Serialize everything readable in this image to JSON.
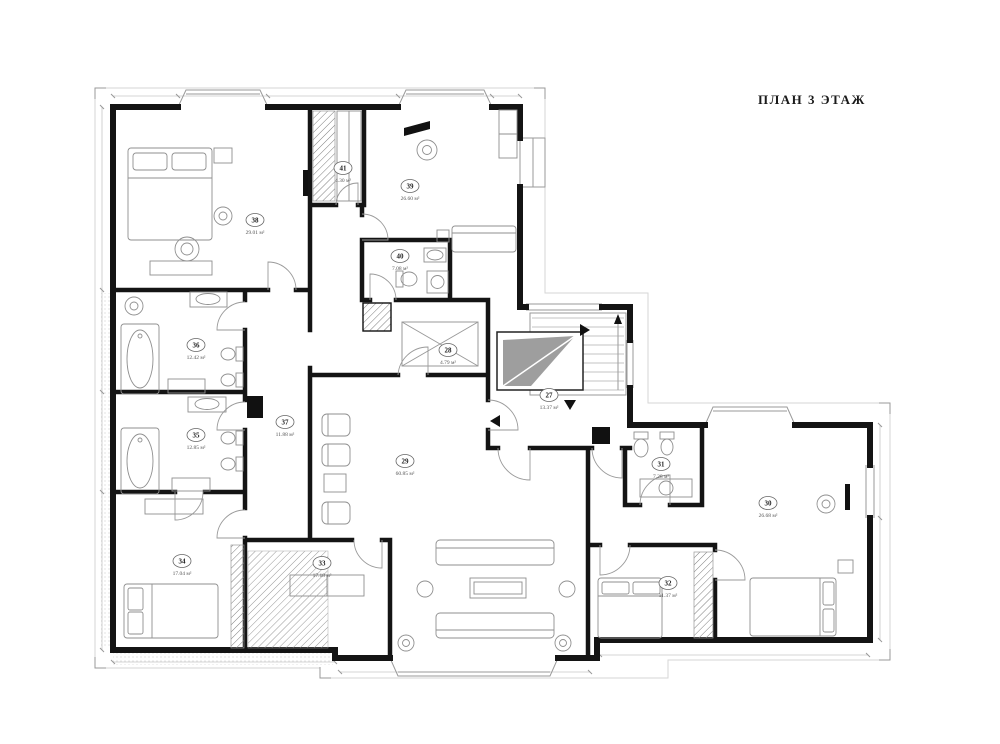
{
  "title": "ПЛАН 3 ЭТАЖ",
  "drawing": {
    "type": "floor-plan",
    "floor_label": "3",
    "units": "м²",
    "palette": {
      "wall": "#141414",
      "furniture_line": "#8f8f8f",
      "stair_wedge": "#9e9e9e",
      "paper": "#ffffff"
    },
    "rooms": [
      {
        "number": "27",
        "area": "13.37 м²",
        "x": 549,
        "y": 399
      },
      {
        "number": "28",
        "area": "4.79 м²",
        "x": 448,
        "y": 354
      },
      {
        "number": "29",
        "area": "60.85 м²",
        "x": 405,
        "y": 465
      },
      {
        "number": "30",
        "area": "26.68 м²",
        "x": 768,
        "y": 507
      },
      {
        "number": "31",
        "area": "7.28 м²",
        "x": 661,
        "y": 468
      },
      {
        "number": "32",
        "area": "11.37 м²",
        "x": 668,
        "y": 587
      },
      {
        "number": "33",
        "area": "17.18 м²",
        "x": 322,
        "y": 567
      },
      {
        "number": "34",
        "area": "17.04 м²",
        "x": 182,
        "y": 565
      },
      {
        "number": "35",
        "area": "12.85 м²",
        "x": 196,
        "y": 439
      },
      {
        "number": "36",
        "area": "12.42 м²",
        "x": 196,
        "y": 349
      },
      {
        "number": "37",
        "area": "11.88 м²",
        "x": 285,
        "y": 426
      },
      {
        "number": "38",
        "area": "29.01 м²",
        "x": 255,
        "y": 224
      },
      {
        "number": "39",
        "area": "26.60 м²",
        "x": 410,
        "y": 190
      },
      {
        "number": "40",
        "area": "7.08 м²",
        "x": 400,
        "y": 260
      },
      {
        "number": "41",
        "area": "4.30 м²",
        "x": 343,
        "y": 172
      }
    ]
  }
}
